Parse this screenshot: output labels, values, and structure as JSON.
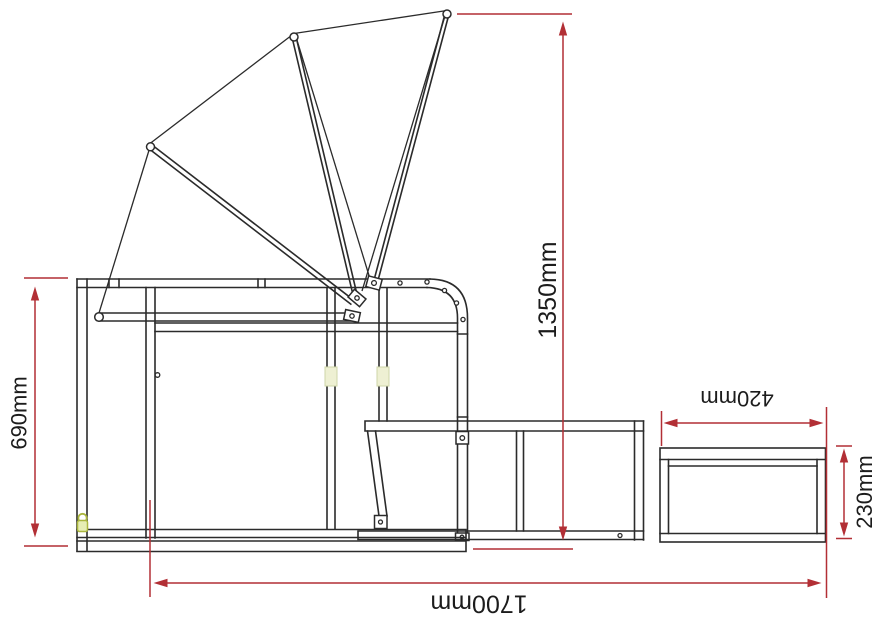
{
  "drawing": {
    "kind": "technical-line-drawing",
    "dimension_labels": {
      "overall_height": "1350mm",
      "bench_height": "690mm",
      "overall_length": "1700mm",
      "side_table_width": "420mm",
      "side_table_height": "230mm"
    },
    "colors": {
      "line": "#2b2b2b",
      "dimension": "#b22f35",
      "background": "#ffffff",
      "clip_highlight": "#eef0d3",
      "lock_accent": "#aab63e"
    }
  }
}
